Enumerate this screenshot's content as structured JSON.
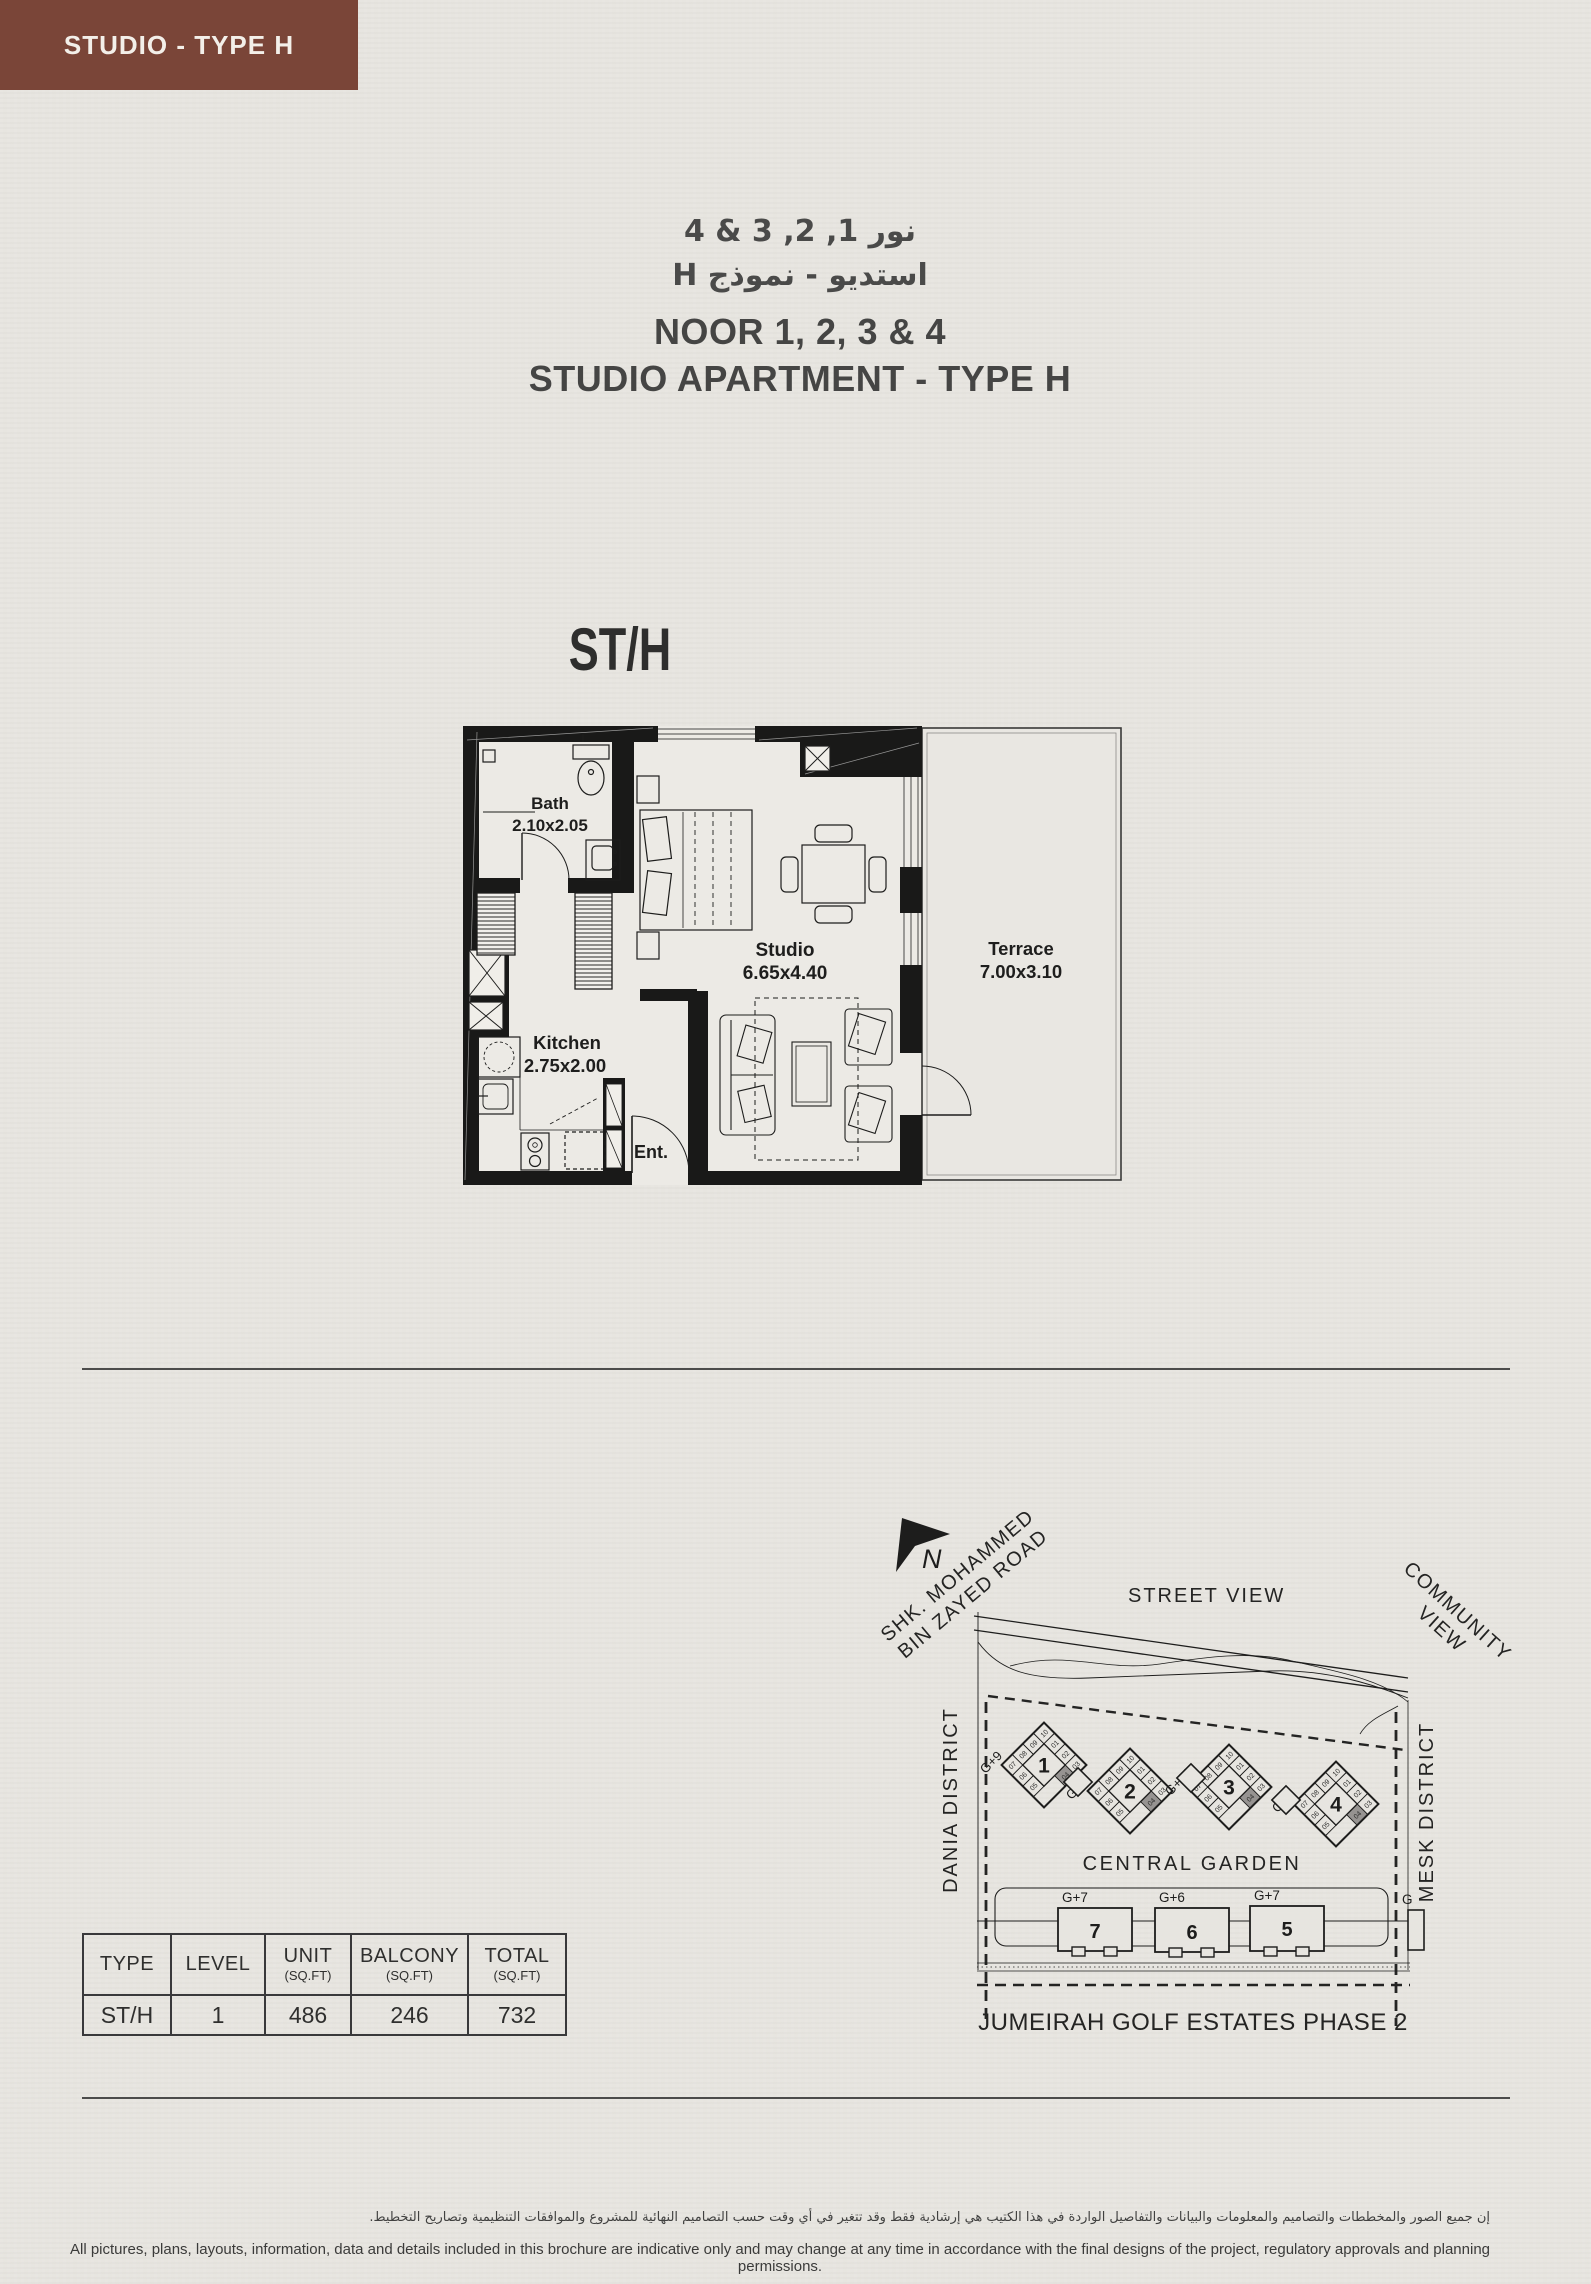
{
  "page": {
    "background": "#e7e5e0",
    "accent_brown": "#7a4538",
    "ink": "#3a3a39",
    "wall_black": "#191918",
    "highlight_gray": "#969391"
  },
  "header": {
    "badge": "STUDIO - TYPE H"
  },
  "title": {
    "arabic_line1": "نور 1, 2, 3 & 4",
    "arabic_line2": "استديو - نموذج H",
    "english_line1": "NOOR 1, 2, 3 & 4",
    "english_line2": "STUDIO APARTMENT - TYPE H"
  },
  "plan": {
    "code": "ST/H",
    "bath_name": "Bath",
    "bath_dims": "2.10x2.05",
    "kitchen_name": "Kitchen",
    "kitchen_dims": "2.75x2.00",
    "studio_name": "Studio",
    "studio_dims": "6.65x4.40",
    "terrace_name": "Terrace",
    "terrace_dims": "7.00x3.10",
    "entrance": "Ent."
  },
  "map": {
    "north": "N",
    "road_line1": "SHK. MOHAMMED",
    "road_line2": "BIN ZAYED  ROAD",
    "street_view": "STREET VIEW",
    "community_line1": "COMMUNITY",
    "community_line2": "VIEW",
    "dania": "DANIA DISTRICT",
    "mesk": "MESK DISTRICT",
    "central_garden": "CENTRAL GARDEN",
    "estate": "JUMEIRAH GOLF ESTATES PHASE 2",
    "partial_label": "G",
    "towers": [
      {
        "number": "1",
        "floors": "G+9",
        "cx": 184,
        "cy": 265
      },
      {
        "number": "2",
        "floors": "G+9",
        "cx": 270,
        "cy": 291
      },
      {
        "number": "3",
        "floors": "G+16",
        "cx": 369,
        "cy": 287
      },
      {
        "number": "4",
        "floors": "G+9",
        "cx": 476,
        "cy": 304
      }
    ],
    "tower_units": {
      "top": [
        "07",
        "08",
        "09",
        "10"
      ],
      "right": [
        "01",
        "02"
      ],
      "left": [
        "06",
        "05"
      ],
      "bottom": [
        "03",
        "04"
      ],
      "highlighted": "04"
    },
    "lowrise": [
      {
        "number": "7",
        "floors": "G+7"
      },
      {
        "number": "6",
        "floors": "G+6"
      },
      {
        "number": "5",
        "floors": "G+7"
      }
    ]
  },
  "table": {
    "headers": [
      {
        "label": "TYPE",
        "sub": ""
      },
      {
        "label": "LEVEL",
        "sub": ""
      },
      {
        "label": "UNIT",
        "sub": "(SQ.FT)"
      },
      {
        "label": "BALCONY",
        "sub": "(SQ.FT)"
      },
      {
        "label": "TOTAL",
        "sub": "(SQ.FT)"
      }
    ],
    "row": [
      "ST/H",
      "1",
      "486",
      "246",
      "732"
    ]
  },
  "footer": {
    "arabic": "إن جميع الصور والمخططات والتصاميم والمعلومات والبيانات والتفاصيل الواردة في هذا الكتيب هي إرشادية فقط وقد تتغير في أي وقت حسب التصاميم النهائية للمشروع والموافقات التنظيمية وتصاريح التخطيط.",
    "english": "All pictures, plans, layouts, information, data and details included in this brochure are indicative only and may change at any time in accordance with the final designs of the project, regulatory approvals and planning permissions."
  }
}
